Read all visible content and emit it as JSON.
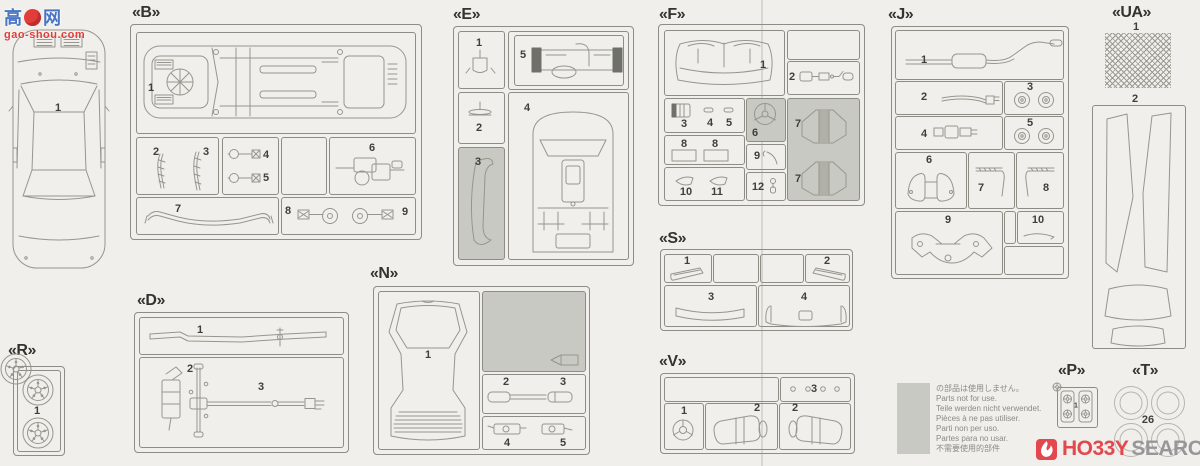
{
  "watermark": {
    "char_left": "高",
    "char_right": "网",
    "site": "gao-shou.com"
  },
  "body": {
    "part": "1"
  },
  "sections": {
    "b": {
      "label": "«B»",
      "p1": "1",
      "p2": "2",
      "p3": "3",
      "p4": "4",
      "p5": "5",
      "p6": "6",
      "p7": "7",
      "p8": "8",
      "p9": "9"
    },
    "e": {
      "label": "«E»",
      "p1": "1",
      "p2": "2",
      "p3": "3",
      "p4": "4",
      "p5": "5"
    },
    "f": {
      "label": "«F»",
      "p1": "1",
      "p2": "2",
      "p3": "3",
      "p4": "4",
      "p5": "5",
      "p6": "6",
      "p7a": "7",
      "p7b": "7",
      "p8a": "8",
      "p8b": "8",
      "p9": "9",
      "p10": "10",
      "p11": "11",
      "p12": "12"
    },
    "s": {
      "label": "«S»",
      "p1": "1",
      "p2": "2",
      "p3": "3",
      "p4": "4"
    },
    "v": {
      "label": "«V»",
      "p1": "1",
      "p2a": "2",
      "p2b": "2",
      "p3": "3"
    },
    "j": {
      "label": "«J»",
      "p1": "1",
      "p2": "2",
      "p3": "3",
      "p4": "4",
      "p5": "5",
      "p6": "6",
      "p7": "7",
      "p8": "8",
      "p9": "9",
      "p10": "10"
    },
    "ua": {
      "label": "«UA»",
      "p1": "1",
      "p2": "2"
    },
    "d": {
      "label": "«D»",
      "p1": "1",
      "p2": "2",
      "p3": "3"
    },
    "n": {
      "label": "«N»",
      "p1": "1",
      "p2": "2",
      "p3": "3",
      "p4": "4",
      "p5": "5"
    },
    "r": {
      "label": "«R»",
      "p1": "1"
    },
    "p": {
      "label": "«P»",
      "p1": "1"
    },
    "t": {
      "label": "«T»",
      "p1": "26"
    }
  },
  "legend": {
    "lines": [
      "の部品は使用しません。",
      "Parts not for use.",
      "Teile werden nicht verwendet.",
      "Pièces à ne pas utiliser.",
      "Parti non per uso.",
      "Partes para no usar.",
      "不需要使用的部件"
    ]
  },
  "logo": {
    "hobby": "HO33Y",
    "search": "SEARCH"
  },
  "colors": {
    "background": "#f0efeb",
    "line": "#96968e",
    "not_for_use_gray": "#c9c9c4",
    "logo_red": "#e2484e",
    "logo_gray": "#97979b",
    "watermark_blue": "#4a74c4",
    "watermark_red": "#e23d3a"
  }
}
